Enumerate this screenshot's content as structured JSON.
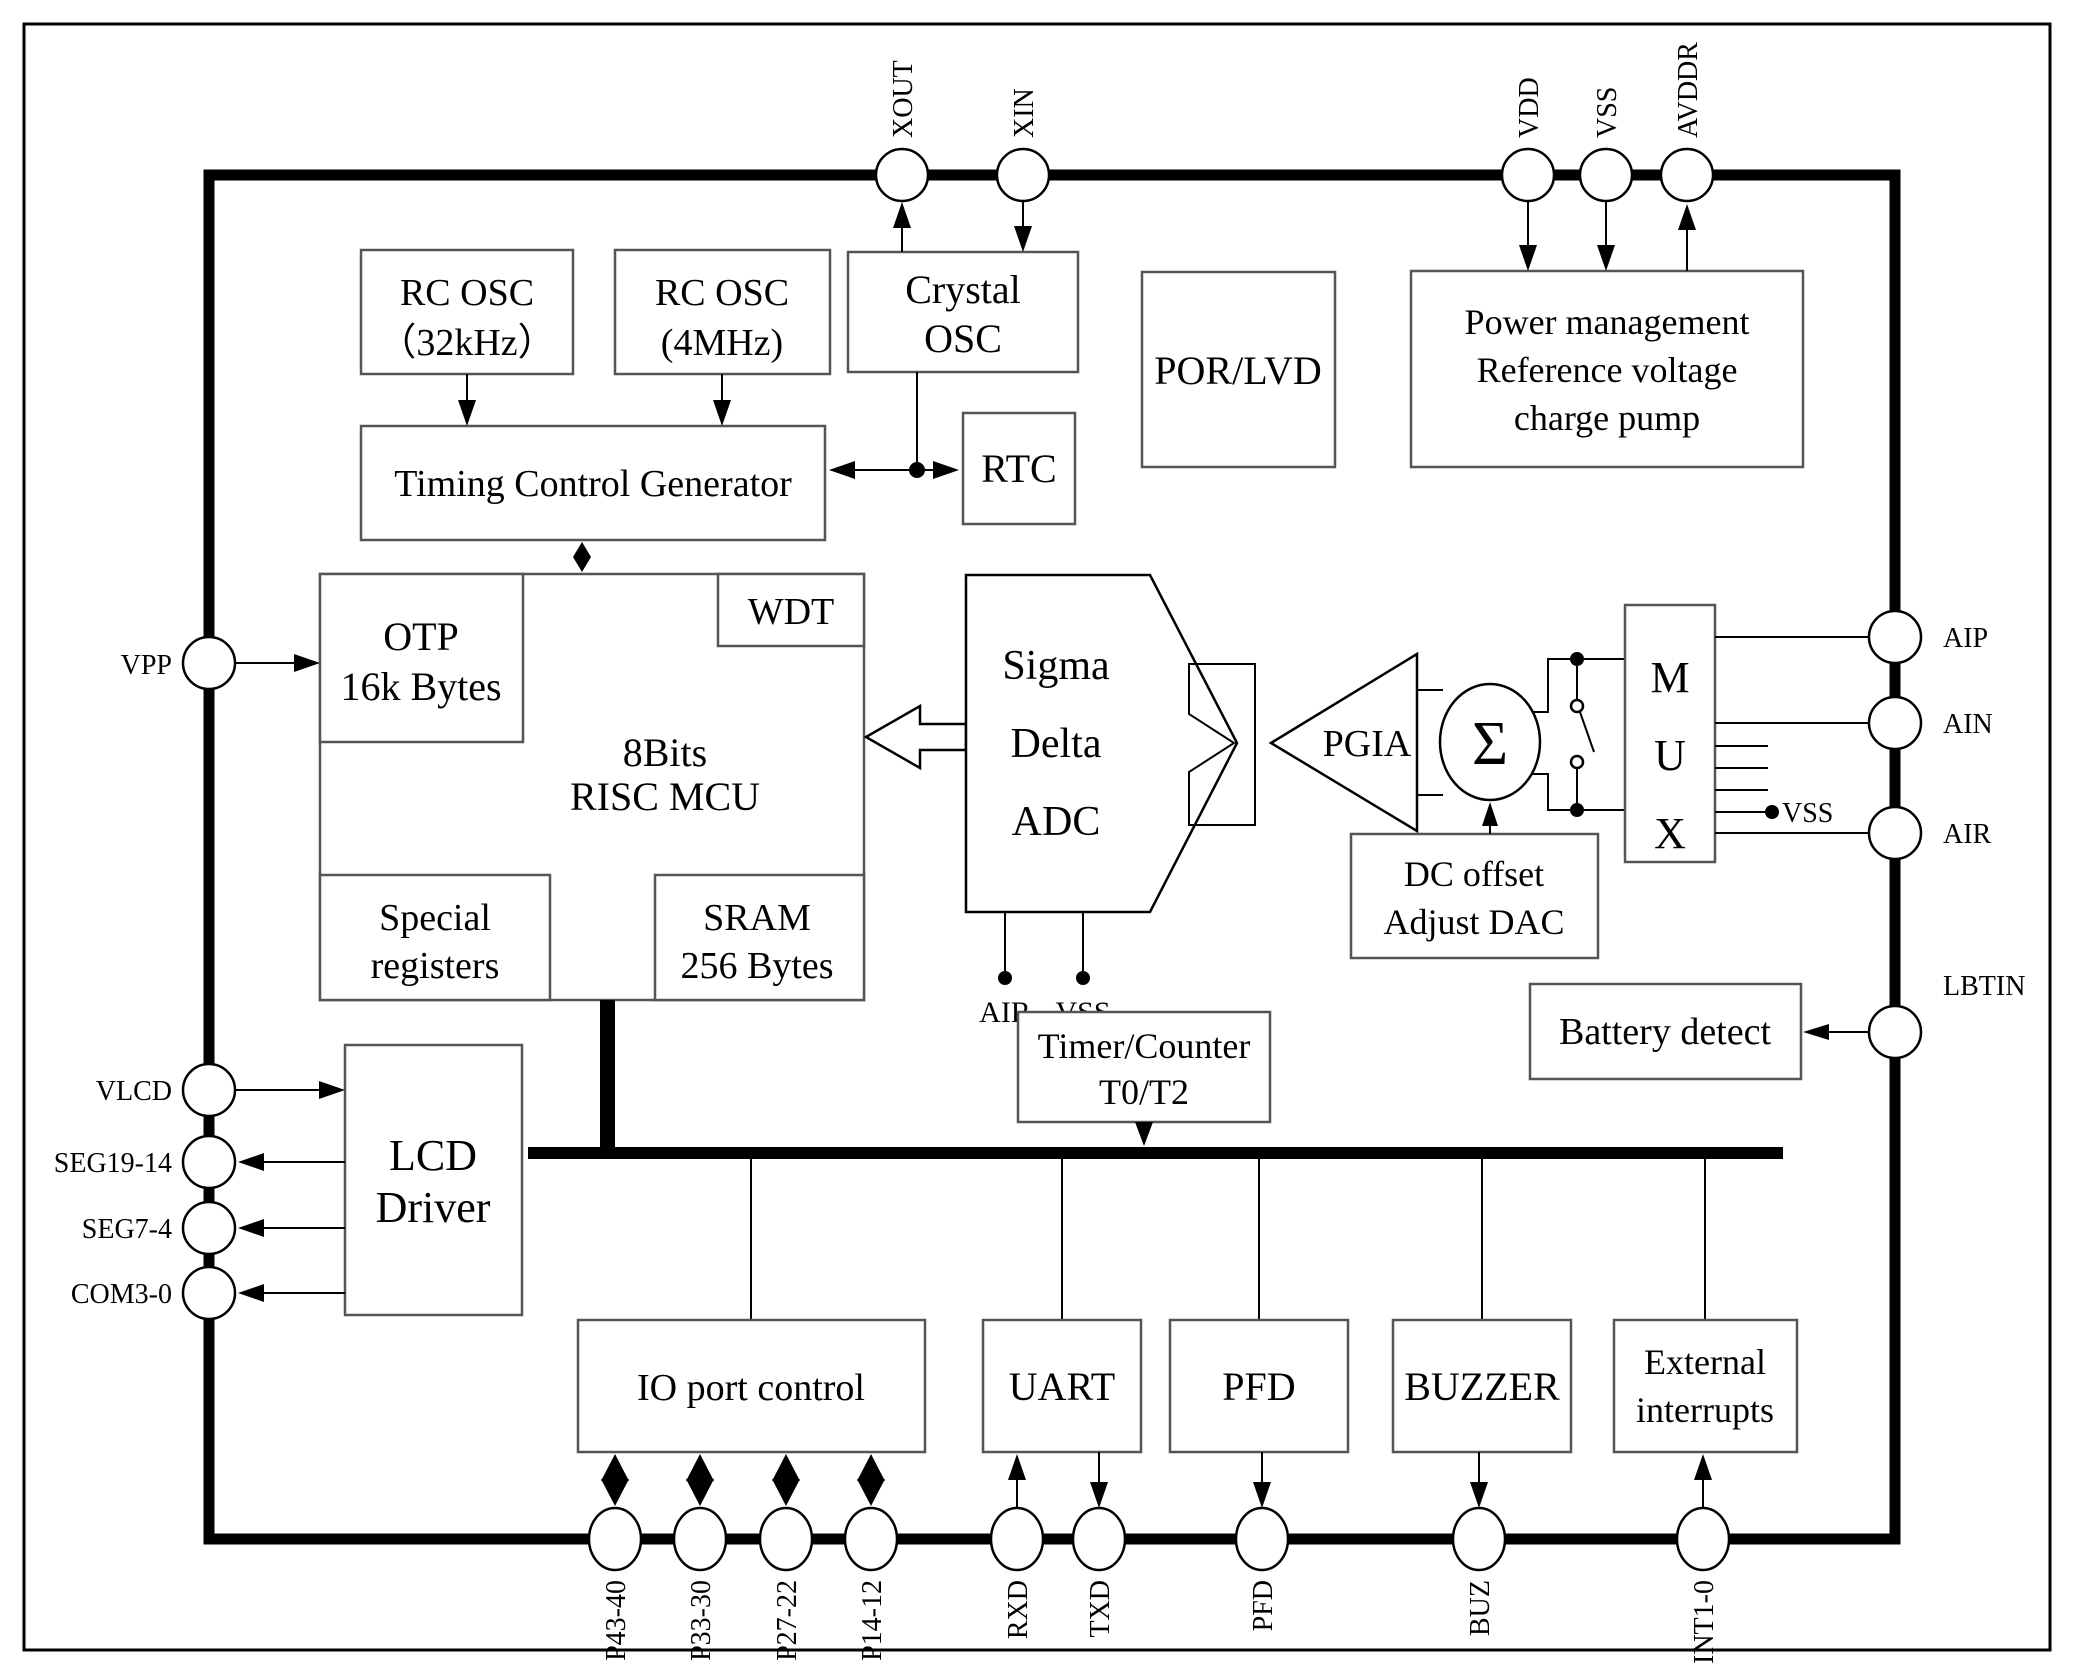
{
  "figure": {
    "type": "soc-block-diagram",
    "background": "#ffffff",
    "line_color": "#000000"
  },
  "blocks": {
    "rc_osc_32k": {
      "l1": "RC OSC",
      "l2": "（32kHz）"
    },
    "rc_osc_4m": {
      "l1": "RC OSC",
      "l2": "(4MHz)"
    },
    "crystal_osc": {
      "l1": "Crystal",
      "l2": "OSC"
    },
    "por_lvd": "POR/LVD",
    "power_mgmt": {
      "l1": "Power management",
      "l2": "Reference voltage",
      "l3": "charge pump"
    },
    "timing": "Timing Control Generator",
    "rtc": "RTC",
    "otp": {
      "l1": "OTP",
      "l2": "16k Bytes"
    },
    "wdt": "WDT",
    "mcu": {
      "l1": "8Bits",
      "l2": "RISC  MCU"
    },
    "special_registers": {
      "l1": "Special",
      "l2": "registers"
    },
    "sram": {
      "l1": "SRAM",
      "l2": "256 Bytes"
    },
    "adc": {
      "l1": "Sigma",
      "l2": "Delta",
      "l3": "ADC"
    },
    "pgia": "PGIA",
    "sigma": "Σ",
    "mux": {
      "l1": "M",
      "l2": "U",
      "l3": "X"
    },
    "dc_offset": {
      "l1": "DC offset",
      "l2": "Adjust DAC"
    },
    "battery": "Battery detect",
    "timer": {
      "l1": "Timer/Counter",
      "l2": "T0/T2"
    },
    "lcd": {
      "l1": "LCD",
      "l2": "Driver"
    },
    "io": "IO port control",
    "uart": "UART",
    "pfd_block": "PFD",
    "buzzer": "BUZZER",
    "ext_int": {
      "l1": "External",
      "l2": "interrupts"
    }
  },
  "pins": {
    "xout": "XOUT",
    "xin": "XIN",
    "vdd": "VDD",
    "vss": "VSS",
    "avddr": "AVDDR",
    "vpp": "VPP",
    "vlcd": "VLCD",
    "seg19_14": "SEG19-14",
    "seg7_4": "SEG7-4",
    "com3_0": "COM3-0",
    "aip": "AIP",
    "ain": "AIN",
    "air": "AIR",
    "lbtin": "LBTIN",
    "p43_40": "P43-40",
    "p33_30": "P33-30",
    "p27_22": "P27-22",
    "p14_12": "P14-12",
    "rxd": "RXD",
    "txd": "TXD",
    "pfd": "PFD",
    "buz": "BUZ",
    "int1_0": "INT1-0"
  },
  "net_labels": {
    "adc_air": "AIR",
    "adc_vss": "VSS",
    "mux_vss": "VSS"
  }
}
